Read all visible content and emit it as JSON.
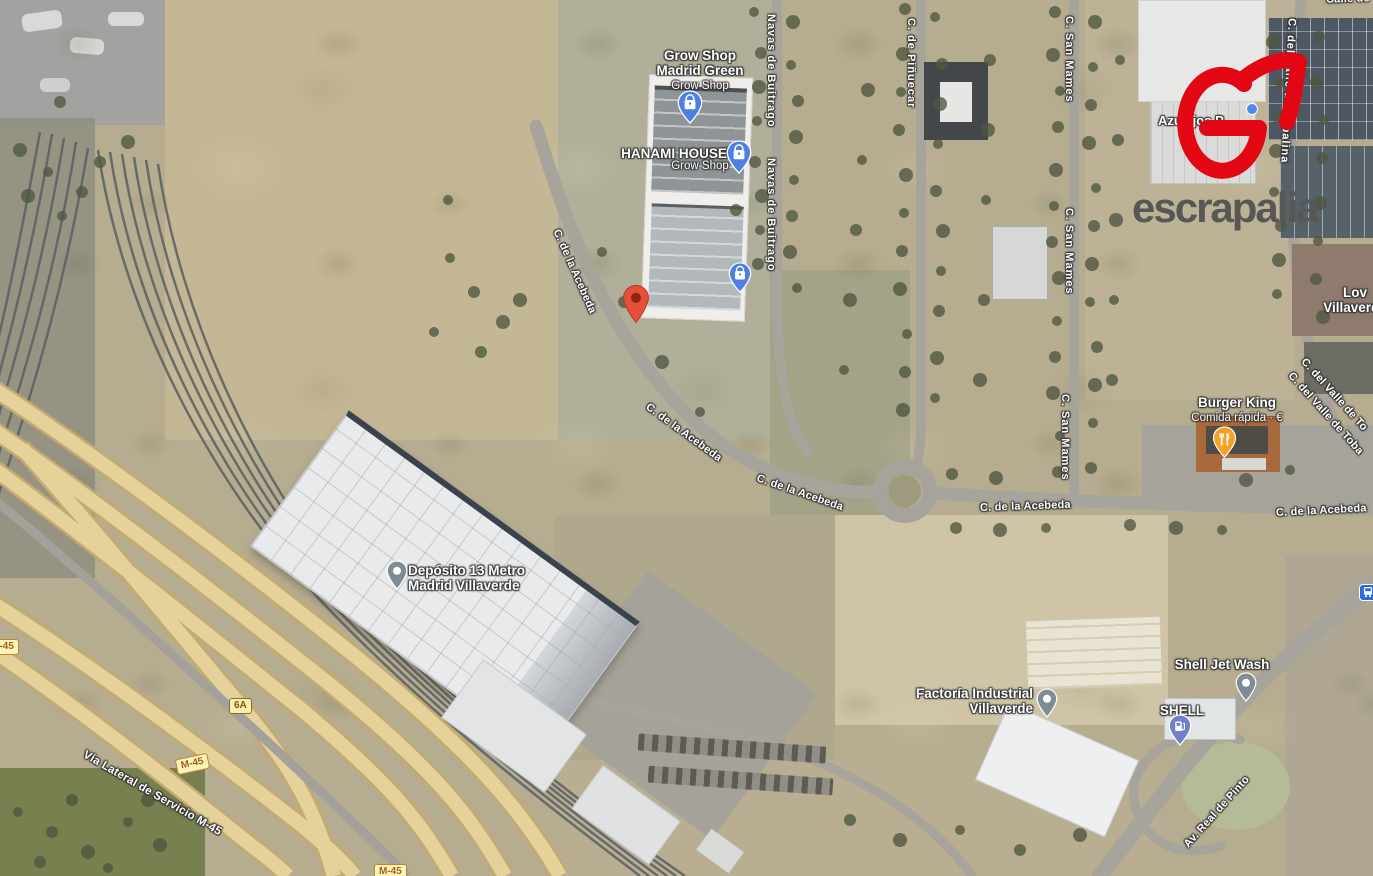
{
  "brand": {
    "logo_text": "escrapalia"
  },
  "pois": {
    "grow_shop_madrid_green": {
      "title": "Grow Shop\nMadrid Green",
      "subtitle": "Grow Shop"
    },
    "hanami_house": {
      "title": "HANAMI HOUSE",
      "subtitle": "Grow Shop"
    },
    "burger_king": {
      "title": "Burger King",
      "subtitle": "Comida rápida · €"
    },
    "deposito_metro": {
      "title": "Depósito 13 Metro\nMadrid Villaverde"
    },
    "factoria_industrial": {
      "title": "Factoría Industrial\nVillaverde"
    },
    "shell_jet_wash": {
      "title": "Shell Jet Wash"
    },
    "shell": {
      "title": "SHELL"
    },
    "azulejos": {
      "title": "Azulejos P"
    },
    "villaverde_partial": {
      "title": "Lov\nVillaverde"
    }
  },
  "streets": {
    "navas_de_buitrago_1": "Navas de Buitrago",
    "navas_de_buitrago_2": "Navas de Buitrago",
    "pinuecar": "C. de Piñuecar",
    "san_mames_1": "C. San Mames",
    "san_mames_2": "C. San Mames",
    "san_mames_3": "C. San Mames",
    "valle_tobalina_vertical": "C. del Valle de Tobalina",
    "valle_tobalina_diag_1": "C. del Valle de To",
    "valle_tobalina_diag_2": "C. del Valle de Toba",
    "acebeda_1": "C. de la Acebeda",
    "acebeda_2": "C. de la Acebeda",
    "acebeda_3": "C. de la Acebeda",
    "acebeda_4": "C. de la Acebeda",
    "acebeda_5": "C. de la Acebeda",
    "calle_top_partial": "Calle de",
    "via_lateral": "Vía Lateral de Servicio M-45",
    "av_real_de_pinto": "Av. Real de Pinto"
  },
  "road_badges": {
    "m45_1": "M-45",
    "m45_2": "M-45",
    "m45_3": "M-45",
    "exit_6a": "6A"
  },
  "icons": {
    "property_marker": "red-location-pin",
    "grow_shop_pin_1": "shopping-bag-pin",
    "grow_shop_pin_2": "shopping-bag-pin",
    "grow_shop_pin_3": "shopping-bag-pin",
    "burger_king_pin": "restaurant-pin",
    "deposito_pin": "place-pin",
    "factoria_pin": "place-pin",
    "shell_jet_wash_pin": "place-pin",
    "shell_fuel_pin": "gas-station-pin",
    "bus_stop": "bus-stop-icon",
    "logo_mark": "escrapalia-e-swoosh"
  },
  "colors": {
    "logo_red": "#e30613",
    "logo_gray": "#575756",
    "pin_blue": "#4e7fe1",
    "pin_amber": "#f4a124",
    "pin_gray": "#7e8c96",
    "pin_indigo": "#7081c9",
    "marker_red": "#e55138"
  }
}
